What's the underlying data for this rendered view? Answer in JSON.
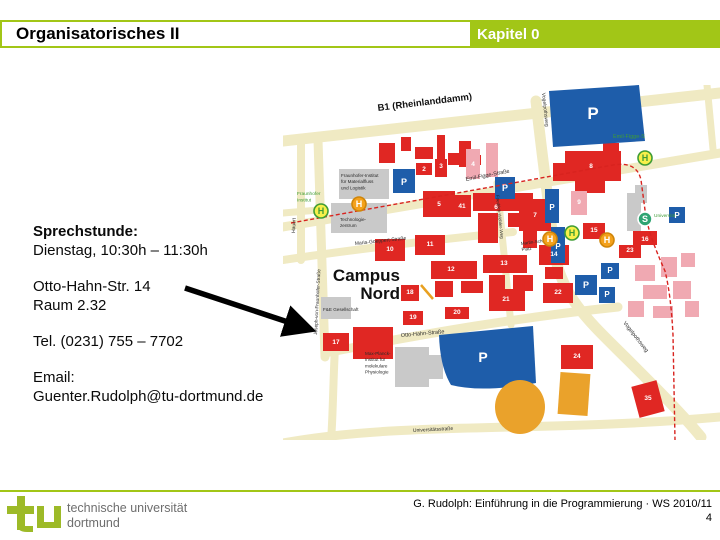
{
  "header": {
    "title": "Organisatorisches II",
    "chapter": "Kapitel 0"
  },
  "body": {
    "sprechstunde_label": "Sprechstunde:",
    "sprechstunde_time": "Dienstag, 10:30h – 11:30h",
    "address_line1": "Otto-Hahn-Str. 14",
    "address_line2": "Raum 2.32",
    "phone": "Tel. (0231) 755 – 7702",
    "email_label": "Email:",
    "email": "Guenter.Rudolph@tu-dortmund.de"
  },
  "footer": {
    "logo_line1": "technische universität",
    "logo_line2": "dortmund",
    "credit": "G. Rudolph: Einführung in die Programmierung · WS 2010/11",
    "page": "4"
  },
  "colors": {
    "accent_green": "#a2c617",
    "logo_green": "#9dba28",
    "map_road": "#f0eac3",
    "building_red": "#e02723",
    "building_pink": "#f0a9b2",
    "building_gray": "#c9c9c9",
    "parking_blue": "#1e5daa",
    "sports_orange": "#eaa22b",
    "boundary_red_dashed": "#d8231f",
    "stop_yellow": "#f7f04a",
    "stop_green": "#3f9c35",
    "stop_orange": "#f4a11b",
    "sbahn_green": "#2fa472"
  },
  "map": {
    "labels": [
      {
        "lines": [
          "B1 (Rheinlanddamm)"
        ],
        "x": 95,
        "y": 26,
        "rot": -7,
        "size": 9.5,
        "bold": true,
        "color": "#111"
      },
      {
        "lines": [
          "Emil-Figge-Straße"
        ],
        "x": 183,
        "y": 96,
        "rot": -11,
        "size": 5.5
      },
      {
        "lines": [
          "Emil-Figge-S"
        ],
        "x": 330,
        "y": 53,
        "size": 5.5,
        "color": "#3f9c35"
      },
      {
        "lines": [
          "Vogelpothsweg"
        ],
        "x": 259,
        "y": 8,
        "rot": 84,
        "size": 5
      },
      {
        "lines": [
          "Vogelpothsweg"
        ],
        "x": 340,
        "y": 238,
        "rot": 52,
        "size": 5.5
      },
      {
        "lines": [
          "Joseph-von-Fraunhofer-Straße"
        ],
        "x": 34,
        "y": 250,
        "rot": -87,
        "size": 4.8
      },
      {
        "lines": [
          "Hauert"
        ],
        "x": 12,
        "y": 148,
        "rot": -88,
        "size": 5
      },
      {
        "lines": [
          "Maria-Goeppert-Straße"
        ],
        "x": 72,
        "y": 160,
        "rot": -6,
        "size": 5
      },
      {
        "lines": [
          "Friedrich-Wöhler-Weg"
        ],
        "x": 213,
        "y": 110,
        "rot": 84,
        "size": 4.5
      },
      {
        "lines": [
          "Otto-Hahn-Straße"
        ],
        "x": 118,
        "y": 252,
        "rot": -5,
        "size": 5.5
      },
      {
        "lines": [
          "Martin-Schmeißer-",
          "Platz"
        ],
        "x": 238,
        "y": 160,
        "rot": -7,
        "size": 4.5
      },
      {
        "lines": [
          "Universitätsstraße"
        ],
        "x": 130,
        "y": 347,
        "rot": -3,
        "size": 5
      },
      {
        "lines": [
          "Campus",
          "Nord"
        ],
        "x": 117,
        "y": 196,
        "size": 17,
        "bold": true,
        "anchor": "end",
        "lh": 18,
        "color": "#111"
      },
      {
        "lines": [
          "Fraunhofer-Institut",
          "für Materialfluss",
          "und Logistik"
        ],
        "x": 58,
        "y": 92,
        "size": 4.6
      },
      {
        "lines": [
          "Technologie-",
          "zentrum"
        ],
        "x": 57,
        "y": 136,
        "size": 4.6
      },
      {
        "lines": [
          "F&E Gesellschaft"
        ],
        "x": 40,
        "y": 226,
        "size": 4.6
      },
      {
        "lines": [
          "Max-Planck-",
          "Institut für",
          "molekulare",
          "Physiologie"
        ],
        "x": 82,
        "y": 270,
        "size": 4.6
      },
      {
        "lines": [
          "Fraunhofer",
          "Institut"
        ],
        "x": 14,
        "y": 110,
        "size": 4.8,
        "color": "#3f9c35"
      },
      {
        "lines": [
          "Universität"
        ],
        "x": 371,
        "y": 132,
        "size": 4.8,
        "color": "#3f9c35"
      }
    ],
    "building_numbers": [
      {
        "n": "2",
        "x": 141,
        "y": 86
      },
      {
        "n": "3",
        "x": 158,
        "y": 83
      },
      {
        "n": "4",
        "x": 190,
        "y": 81
      },
      {
        "n": "5",
        "x": 156,
        "y": 121
      },
      {
        "n": "41",
        "x": 179,
        "y": 123
      },
      {
        "n": "6",
        "x": 213,
        "y": 124
      },
      {
        "n": "7",
        "x": 252,
        "y": 132
      },
      {
        "n": "8",
        "x": 308,
        "y": 83
      },
      {
        "n": "9",
        "x": 296,
        "y": 119
      },
      {
        "n": "15",
        "x": 311,
        "y": 147
      },
      {
        "n": "16",
        "x": 362,
        "y": 156
      },
      {
        "n": "23",
        "x": 347,
        "y": 167
      },
      {
        "n": "10",
        "x": 107,
        "y": 166
      },
      {
        "n": "11",
        "x": 147,
        "y": 161
      },
      {
        "n": "12",
        "x": 168,
        "y": 186
      },
      {
        "n": "13",
        "x": 221,
        "y": 180
      },
      {
        "n": "21",
        "x": 223,
        "y": 216
      },
      {
        "n": "14",
        "x": 271,
        "y": 171
      },
      {
        "n": "22",
        "x": 275,
        "y": 209
      },
      {
        "n": "18",
        "x": 127,
        "y": 209
      },
      {
        "n": "19",
        "x": 130,
        "y": 234
      },
      {
        "n": "20",
        "x": 174,
        "y": 229
      },
      {
        "n": "24",
        "x": 294,
        "y": 273
      },
      {
        "n": "17",
        "x": 53,
        "y": 259
      },
      {
        "n": "35",
        "x": 365,
        "y": 315
      }
    ],
    "parking_marks": [
      {
        "x": 310,
        "y": 34,
        "s": 17
      },
      {
        "x": 200,
        "y": 277,
        "s": 14
      },
      {
        "x": 121,
        "y": 100,
        "s": 9
      },
      {
        "x": 222,
        "y": 106,
        "s": 9
      },
      {
        "x": 269,
        "y": 125,
        "s": 8
      },
      {
        "x": 275,
        "y": 164,
        "s": 8
      },
      {
        "x": 303,
        "y": 203,
        "s": 9
      },
      {
        "x": 327,
        "y": 188,
        "s": 8
      },
      {
        "x": 324,
        "y": 212,
        "s": 8
      },
      {
        "x": 394,
        "y": 133,
        "s": 8
      }
    ],
    "stops": [
      {
        "letter": "H",
        "style": "bus_yellow",
        "x": 38,
        "y": 126
      },
      {
        "letter": "H",
        "style": "bus_orange",
        "x": 76,
        "y": 119
      },
      {
        "letter": "H",
        "style": "bus_orange",
        "x": 267,
        "y": 154
      },
      {
        "letter": "H",
        "style": "bus_yellow",
        "x": 289,
        "y": 148
      },
      {
        "letter": "H",
        "style": "bus_orange",
        "x": 324,
        "y": 155
      },
      {
        "letter": "H",
        "style": "bus_yellow",
        "x": 362,
        "y": 73
      },
      {
        "letter": "S",
        "style": "sbahn",
        "x": 362,
        "y": 134
      }
    ]
  }
}
